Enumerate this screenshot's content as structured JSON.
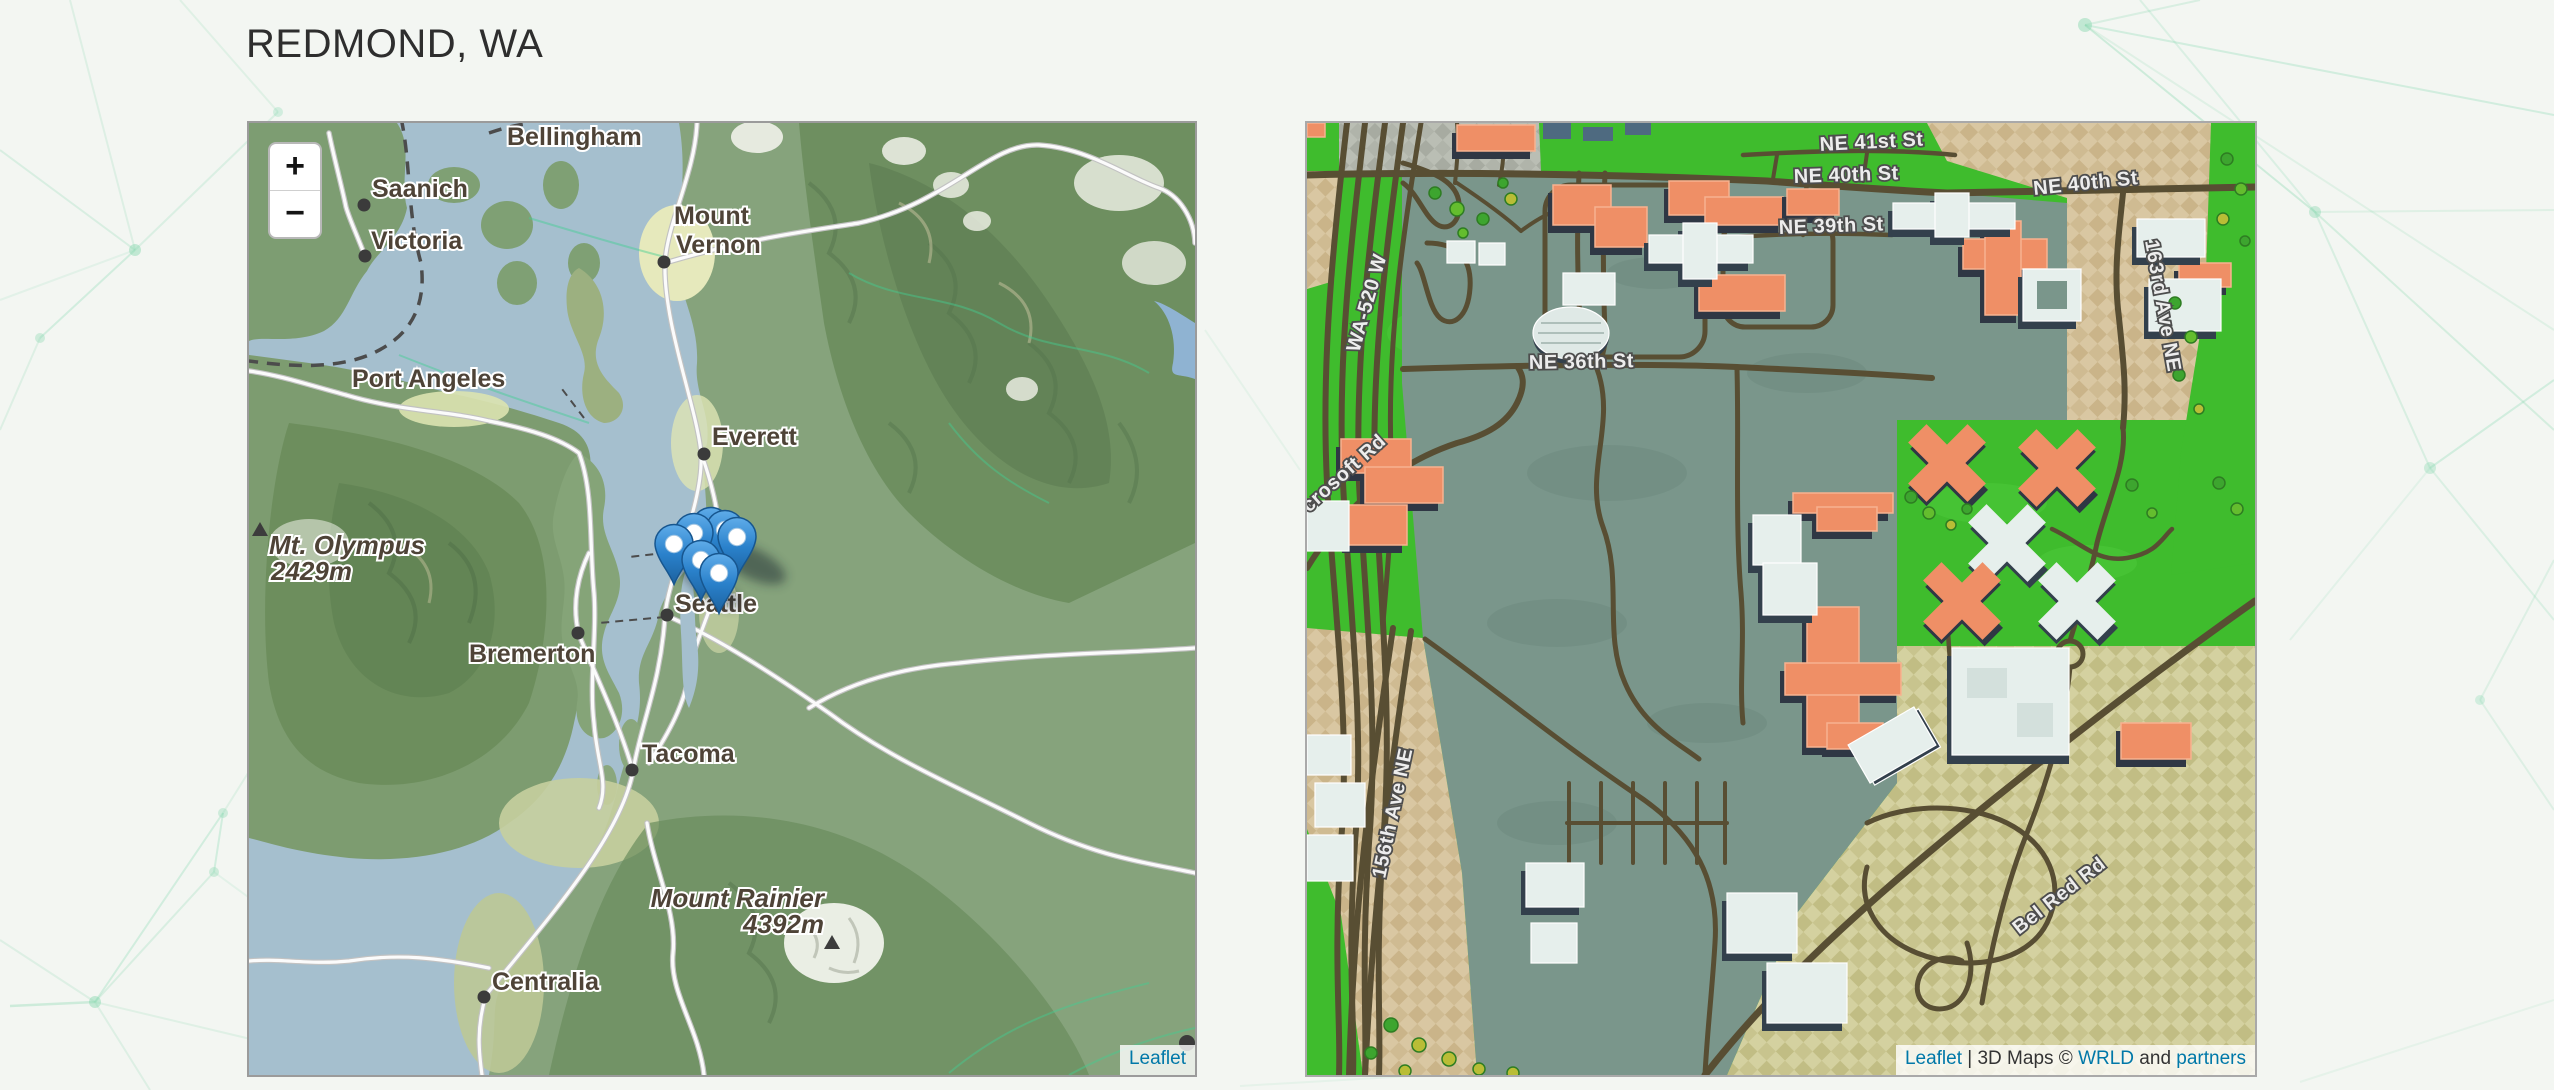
{
  "page": {
    "title": "REDMOND, WA"
  },
  "left_map": {
    "name": "Puget Sound overview map",
    "zoom_in_label": "+",
    "zoom_out_label": "−",
    "attribution_link": "Leaflet",
    "cities": {
      "bellingham": "Bellingham",
      "saanich": "Saanich",
      "victoria": "Victoria",
      "mount_vernon_line1": "Mount",
      "mount_vernon_line2": "Vernon",
      "port_angeles": "Port Angeles",
      "everett": "Everett",
      "seattle": "Seattle",
      "bremerton": "Bremerton",
      "tacoma": "Tacoma",
      "centralia": "Centralia"
    },
    "peaks": {
      "olympus_name": "Mt. Olympus",
      "olympus_elevation": "2429m",
      "rainier_name": "Mount Rainier",
      "rainier_elevation": "4392m"
    }
  },
  "right_map": {
    "name": "Redmond 3D buildings map",
    "streets": {
      "ne_41st": "NE 41st St",
      "ne_40th_west": "NE 40th St",
      "ne_40th_east": "NE 40th St",
      "ne_39th": "NE 39th St",
      "ne_36th": "NE 36th St",
      "wa_520": "WA-520 W",
      "ave_163rd": "163rd Ave NE",
      "ave_156th": "156th Ave NE",
      "microsoft_rd_partial": "crosoft Rd",
      "bel_red_rd": "Bel Red Rd"
    },
    "attribution": {
      "leaflet_link": "Leaflet",
      "middle_text": " | 3D Maps © ",
      "wrld_link": "WRLD",
      "and_text": " and ",
      "partners_link": "partners"
    }
  },
  "colors": {
    "page_background": "#f3f6f2",
    "pattern_green": "#86d8ae",
    "title_text": "#2e2e2e",
    "link_blue": "#0078a8",
    "marker_blue": "#2a81cb",
    "water": "#a5bfce",
    "terrain_green": "#86a37c",
    "mountain_green": "#5b7b52",
    "lowland_yellow": "#e6e9bc",
    "wrld_grass_green": "#3fbc2d",
    "wrld_campus_sage": "#7a968b",
    "wrld_ground_tan": "#d9c7a2",
    "wrld_ground_khaki": "#d2cf9d",
    "wrld_road_brown": "#584e33",
    "building_orange": "#ef8f66",
    "building_white": "#e6efec"
  }
}
